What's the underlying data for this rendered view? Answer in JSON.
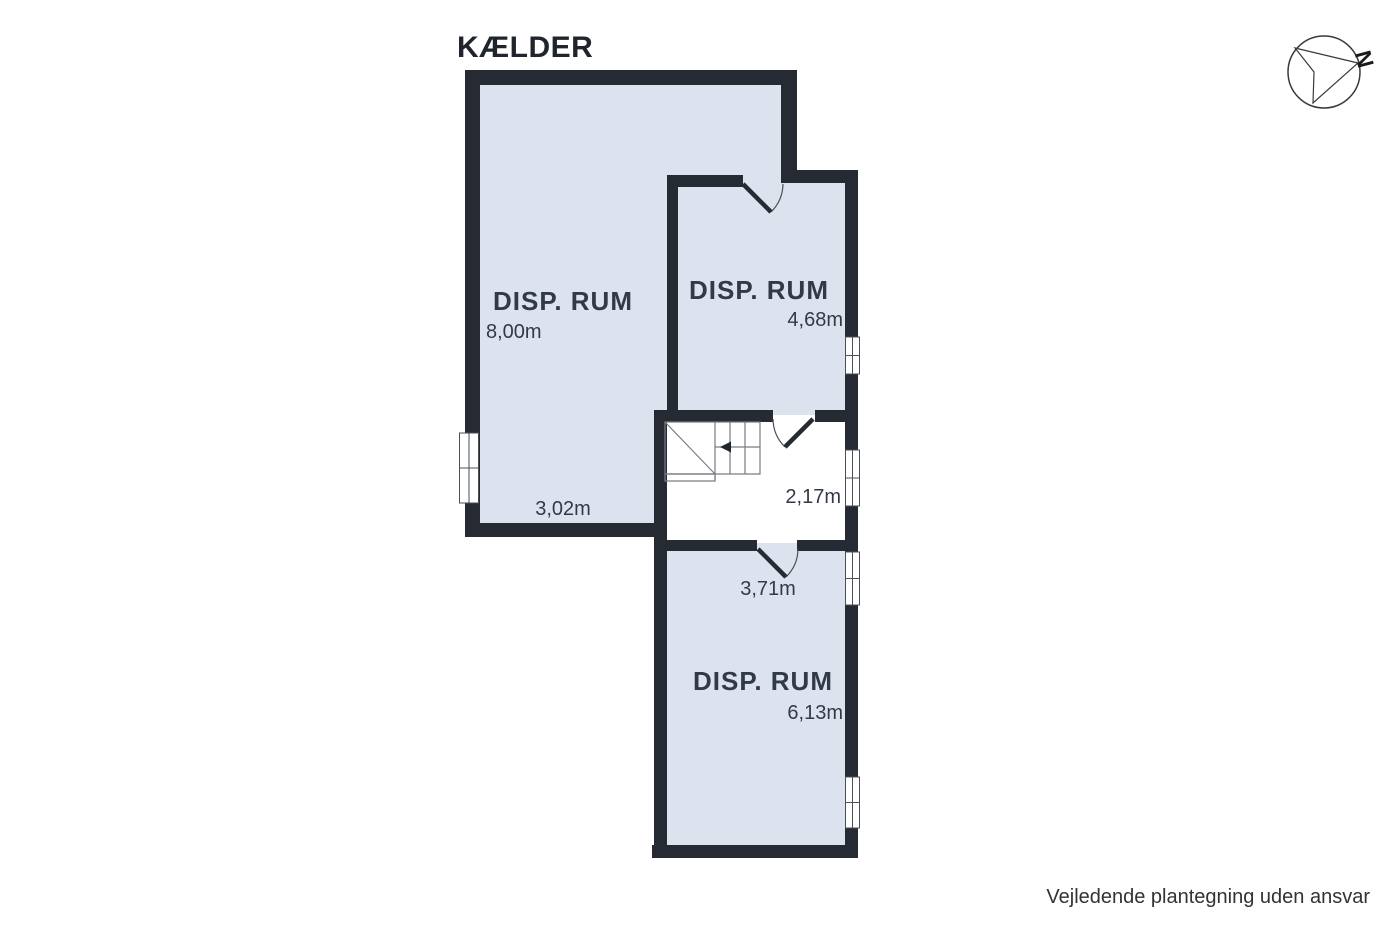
{
  "title": "KÆLDER",
  "disclaimer": "Vejledende plantegning uden ansvar",
  "compass": {
    "north_label": "N"
  },
  "rooms": {
    "large": {
      "label": "DISP. RUM",
      "length": "8,00m",
      "width": "3,02m"
    },
    "top_right": {
      "label": "DISP. RUM",
      "length": "4,68m"
    },
    "stair_hall": {
      "width": "2,17m"
    },
    "bottom": {
      "label": "DISP. RUM",
      "width": "3,71m",
      "length": "6,13m"
    }
  },
  "colors": {
    "wall": "#262a33",
    "room_fill": "#dde3ee",
    "hall_fill": "#ffffff",
    "label_text": "#333a47",
    "title_text": "#20242c"
  }
}
